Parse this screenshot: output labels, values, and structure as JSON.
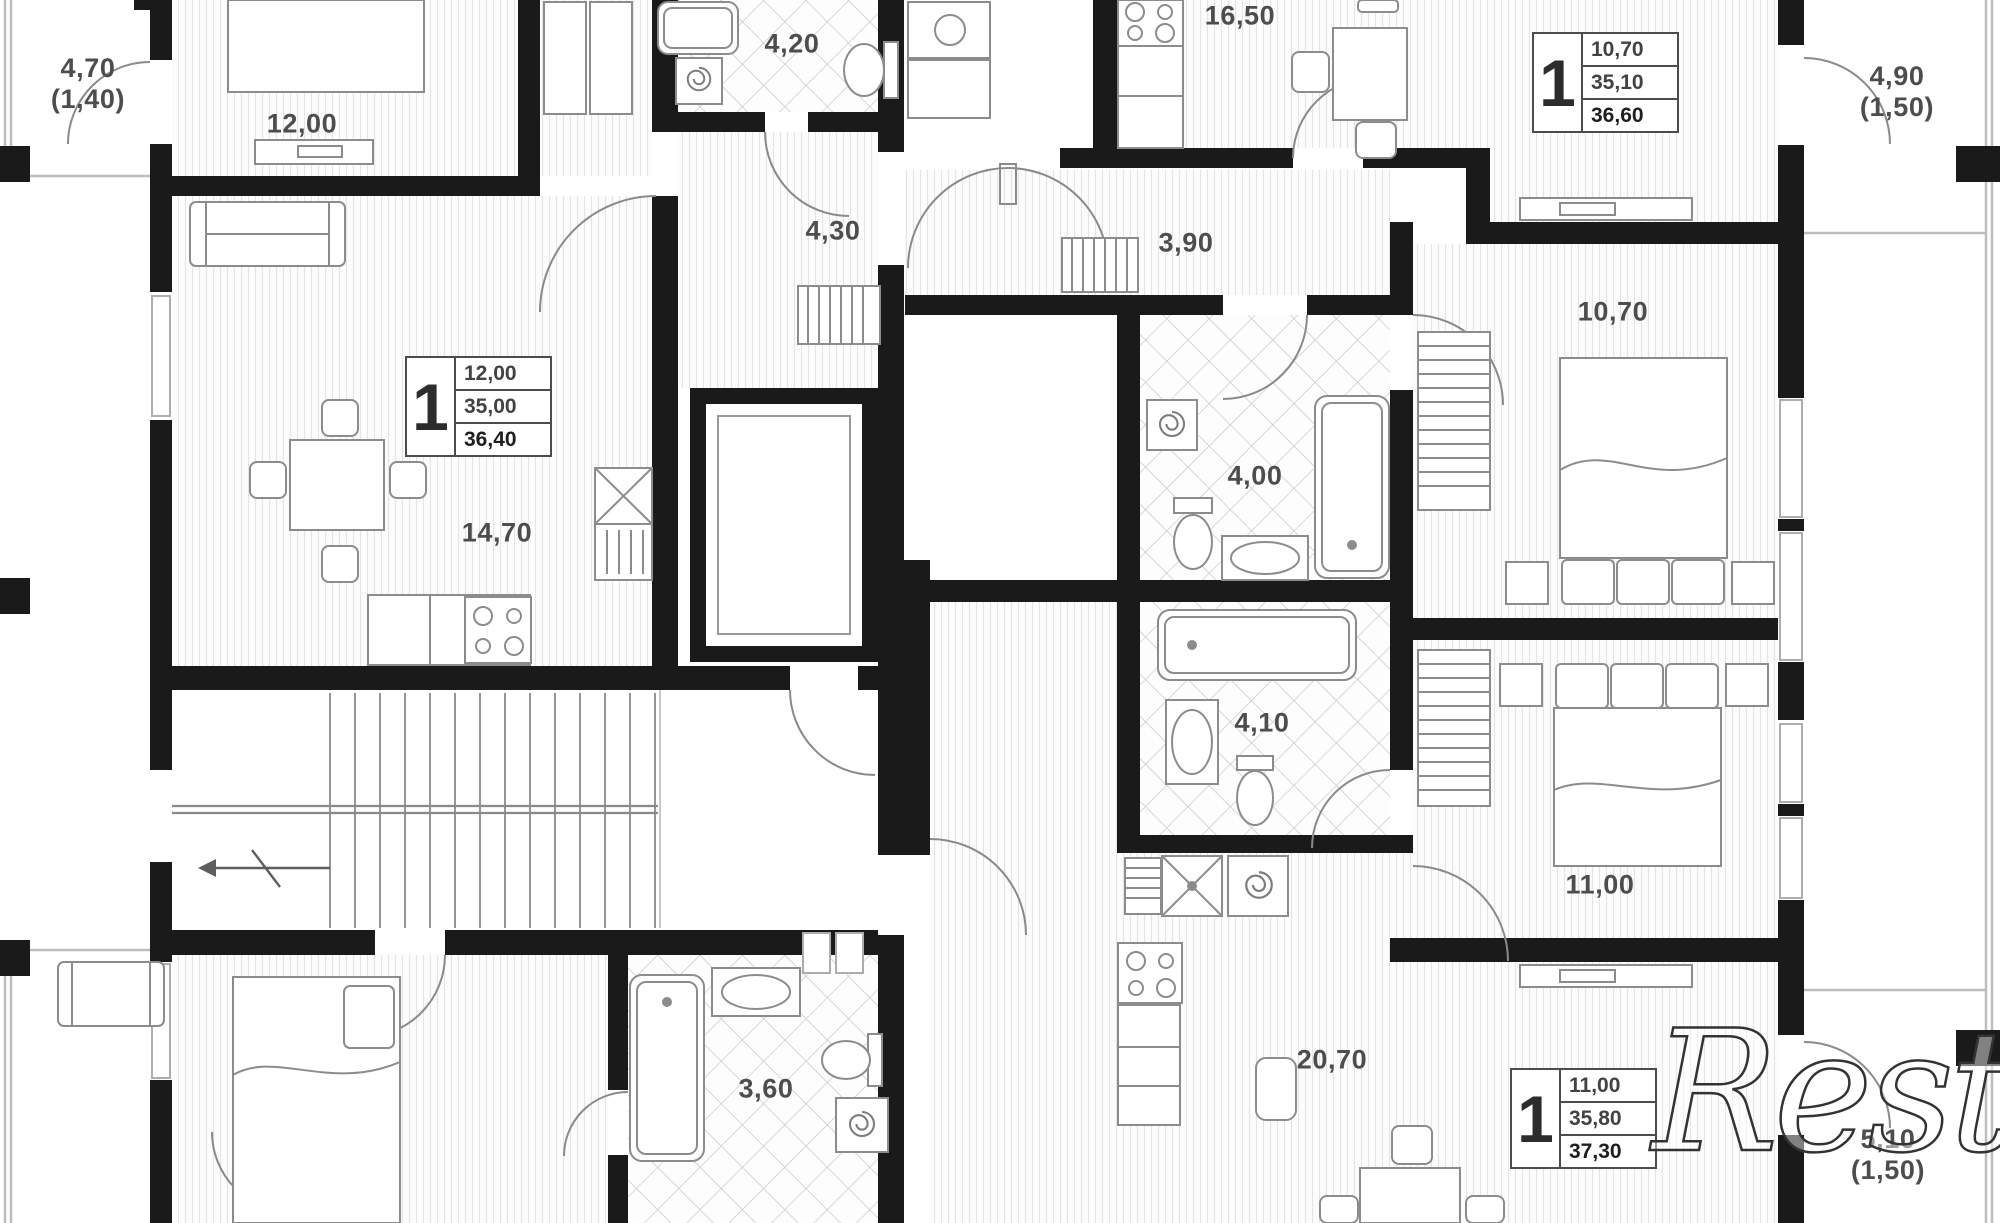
{
  "labels": {
    "balcony_top_left_area": "4,70",
    "balcony_top_left_reduced": "(1,40)",
    "room_12": "12,00",
    "bathroom_top": "4,20",
    "hallway_left": "4,30",
    "kitchen_living_right": "16,50",
    "hallway_right": "3,90",
    "balcony_top_right_area": "4,90",
    "balcony_top_right_reduced": "(1,50)",
    "kitchen_living_left": "14,70",
    "bathroom_right_upper": "4,00",
    "bathroom_right_lower": "4,10",
    "bedroom_right_upper": "10,70",
    "bedroom_right_lower": "11,00",
    "bathroom_bottom": "3,60",
    "living_bottom_right": "20,70",
    "balcony_bottom_right_area": "5,10",
    "balcony_bottom_right_reduced": "(1,50)"
  },
  "apartment_cards": [
    {
      "rooms": "1",
      "room_area": "12,00",
      "living_area": "35,00",
      "total_area": "36,40"
    },
    {
      "rooms": "1",
      "room_area": "10,70",
      "living_area": "35,10",
      "total_area": "36,60"
    },
    {
      "rooms": "1",
      "room_area": "11,00",
      "living_area": "35,80",
      "total_area": "37,30"
    }
  ],
  "watermark": "Restate"
}
